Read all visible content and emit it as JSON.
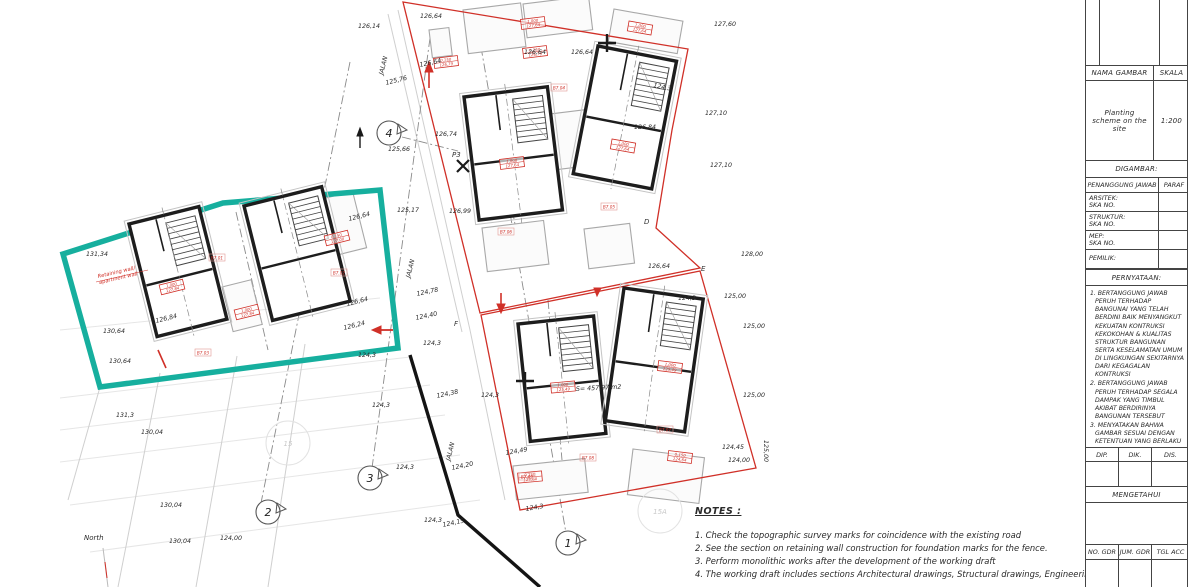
{
  "colors": {
    "teal": "#16af9e",
    "red": "#d03028",
    "wall": "#1d1d1d"
  },
  "title_block": {
    "nama_gambar_label": "NAMA GAMBAR",
    "skala_label": "SKALA",
    "drawing_title": "Planting scheme on the site",
    "scale_value": "1:200",
    "digambar_label": "DIGAMBAR:",
    "penanggung_label": "PENANGGUNG JAWAB",
    "paraf_label": "PARAF",
    "party_rows": [
      {
        "label": "ARSITEK:",
        "sub": "SKA NO."
      },
      {
        "label": "STRUKTUR:",
        "sub": "SKA NO."
      },
      {
        "label": "MEP:",
        "sub": "SKA NO."
      },
      {
        "label": "PEMILIK:",
        "sub": ""
      }
    ],
    "pernyataan_label": "PERNYATAAN:",
    "statements": [
      "1. BERTANGGUNG JAWAB PERUH TERHADAP BANGUNAI YANG TELAH BERDINI BAIK MENYANGKUT KEKUATAN KONTRUKSI KEKOKOHAN & KUALITAS STRUKTUR BANGUNAN SERTA KESELAMATAN UMUM DI LINGKUNGAN SEKITARNYA DARI KEGAGALAN KONTRUKSI",
      "2. BERTANGGUNG JAWAB PERUH TERHADAP SEGALA DAMPAK YANG TIMBUL AKIBAT BERDIRINYA BANGUNAN TERSEBUT",
      "3. MENYATAKAN BAHWA GAMBAR SESUAI DENGAN KETENTUAN YANG BERLAKU"
    ],
    "sign_columns": [
      "DIP.",
      "DIK.",
      "DIS."
    ],
    "mengetahui_label": "MENGETAHUI",
    "footer_columns": [
      "NO. GDR",
      "JUM. GDR",
      "TGL ACC"
    ]
  },
  "notes": {
    "heading": "NOTES :",
    "items": [
      "1. Check the topographic survey marks for coincidence with the existing road",
      "2. See the section on retaining wall construction for foundation marks for the fence.",
      "3. Perform monolithic works after the development of the working draft",
      "4. The working draft includes sections Architectural drawings, Structural drawings, Engineering."
    ]
  },
  "plan": {
    "north_label": "North",
    "retaining_note": [
      "Retaining wall/",
      "apartment wall"
    ],
    "labels": [
      {
        "t": "126,14",
        "x": 358,
        "y": 28
      },
      {
        "t": "126,64",
        "x": 420,
        "y": 18
      },
      {
        "t": "126,64",
        "x": 524,
        "y": 54
      },
      {
        "t": "126,64",
        "x": 571,
        "y": 54
      },
      {
        "t": "126,64",
        "x": 420,
        "y": 67,
        "rot": -12
      },
      {
        "t": "127,60",
        "x": 714,
        "y": 26
      },
      {
        "t": "127,10",
        "x": 705,
        "y": 115
      },
      {
        "t": "127,10",
        "x": 710,
        "y": 167
      },
      {
        "t": "128,00",
        "x": 741,
        "y": 256
      },
      {
        "t": "126,64",
        "x": 648,
        "y": 268
      },
      {
        "t": "125,00",
        "x": 724,
        "y": 298
      },
      {
        "t": "124,3",
        "x": 678,
        "y": 300
      },
      {
        "t": "126,84",
        "x": 634,
        "y": 129
      },
      {
        "t": "126,74",
        "x": 435,
        "y": 136
      },
      {
        "t": "125,76",
        "x": 386,
        "y": 85,
        "rot": -14
      },
      {
        "t": "125,66",
        "x": 388,
        "y": 151
      },
      {
        "t": "125,17",
        "x": 397,
        "y": 212
      },
      {
        "t": "126,99",
        "x": 449,
        "y": 213
      },
      {
        "t": "131,34",
        "x": 86,
        "y": 256
      },
      {
        "t": "126,84",
        "x": 156,
        "y": 323,
        "rot": -14
      },
      {
        "t": "130,64",
        "x": 103,
        "y": 333
      },
      {
        "t": "130,64",
        "x": 109,
        "y": 363
      },
      {
        "t": "126,64",
        "x": 349,
        "y": 221,
        "rot": -14
      },
      {
        "t": "126,64",
        "x": 347,
        "y": 306,
        "rot": -14
      },
      {
        "t": "126,24",
        "x": 344,
        "y": 330,
        "rot": -14
      },
      {
        "t": "124,3",
        "x": 358,
        "y": 357
      },
      {
        "t": "124,78",
        "x": 417,
        "y": 296,
        "rot": -12
      },
      {
        "t": "124,40",
        "x": 416,
        "y": 320,
        "rot": -12
      },
      {
        "t": "124,3",
        "x": 423,
        "y": 345
      },
      {
        "t": "124,38",
        "x": 437,
        "y": 398,
        "rot": -12
      },
      {
        "t": "124,20",
        "x": 452,
        "y": 470,
        "rot": -12
      },
      {
        "t": "124,3",
        "x": 396,
        "y": 469
      },
      {
        "t": "124,3",
        "x": 424,
        "y": 522
      },
      {
        "t": "124,15",
        "x": 443,
        "y": 527,
        "rot": -12
      },
      {
        "t": "124,3",
        "x": 481,
        "y": 397
      },
      {
        "t": "125,00",
        "x": 743,
        "y": 328
      },
      {
        "t": "125,00",
        "x": 743,
        "y": 397
      },
      {
        "t": "124,49",
        "x": 506,
        "y": 455,
        "rot": -10
      },
      {
        "t": "124,45",
        "x": 722,
        "y": 449
      },
      {
        "t": "124,00",
        "x": 728,
        "y": 462
      },
      {
        "t": "125,00",
        "x": 764,
        "y": 440,
        "rot": 90
      },
      {
        "t": "124,3",
        "x": 526,
        "y": 511,
        "rot": -10
      },
      {
        "t": "124,00",
        "x": 220,
        "y": 540
      },
      {
        "t": "131,3",
        "x": 116,
        "y": 417
      },
      {
        "t": "130,04",
        "x": 141,
        "y": 434
      },
      {
        "t": "130,04",
        "x": 160,
        "y": 507
      },
      {
        "t": "130,04",
        "x": 169,
        "y": 543
      },
      {
        "t": "124,3",
        "x": 372,
        "y": 407
      },
      {
        "t": "124,3",
        "x": 653,
        "y": 87,
        "rot": 12
      },
      {
        "t": "S= 457,97 m2",
        "x": 576,
        "y": 391,
        "rot": -3
      },
      {
        "t": "JALAN",
        "x": 383,
        "y": 75,
        "rot": -76
      },
      {
        "t": "JALAN",
        "x": 410,
        "y": 278,
        "rot": -76
      },
      {
        "t": "JALAN",
        "x": 450,
        "y": 461,
        "rot": -76
      }
    ],
    "grid_letters": [
      {
        "t": "D",
        "x": 644,
        "y": 224
      },
      {
        "t": "E",
        "x": 701,
        "y": 271
      },
      {
        "t": "F",
        "x": 454,
        "y": 326
      },
      {
        "t": "P3",
        "x": 452,
        "y": 157
      }
    ],
    "axis_bubbles": [
      {
        "n": "1",
        "x": 568,
        "y": 543
      },
      {
        "n": "2",
        "x": 268,
        "y": 512
      },
      {
        "n": "3",
        "x": 370,
        "y": 478
      },
      {
        "n": "4",
        "x": 389,
        "y": 133
      }
    ],
    "ref_circles": [
      {
        "n": "15",
        "x": 288,
        "y": 443
      },
      {
        "n": "15A",
        "x": 660,
        "y": 511
      }
    ],
    "level_boxes": [
      {
        "x": 533,
        "y": 23,
        "l1": "1,000",
        "l2": "127,64",
        "rot": -7
      },
      {
        "x": 640,
        "y": 28,
        "l1": "1,000",
        "l2": "127,64",
        "rot": 10
      },
      {
        "x": 535,
        "y": 52,
        "l1": "0,150",
        "l2": "126,79",
        "rot": -7
      },
      {
        "x": 446,
        "y": 62,
        "l1": "0,150",
        "l2": "126,79",
        "rot": -7
      },
      {
        "x": 623,
        "y": 146,
        "l1": "1,000",
        "l2": "127,64",
        "rot": 10
      },
      {
        "x": 512,
        "y": 163,
        "l1": "1,000",
        "l2": "127,64",
        "rot": -7
      },
      {
        "x": 172,
        "y": 287,
        "l1": "1,000",
        "l2": "127,84",
        "rot": -14
      },
      {
        "x": 247,
        "y": 312,
        "l1": "1,000",
        "l2": "127,84",
        "rot": -14
      },
      {
        "x": 337,
        "y": 238,
        "l1": "0,150",
        "l2": "127,00",
        "rot": -14
      },
      {
        "x": 563,
        "y": 387,
        "l1": "1,000",
        "l2": "125,49",
        "rot": -5
      },
      {
        "x": 670,
        "y": 367,
        "l1": "1,000",
        "l2": "125,49",
        "rot": 7
      },
      {
        "x": 680,
        "y": 457,
        "l1": "0,150",
        "l2": "124,64",
        "rot": 7
      },
      {
        "x": 530,
        "y": 477,
        "l1": "0,150",
        "l2": "124,64",
        "rot": -5
      }
    ],
    "red_tags": [
      {
        "t": "B7.01",
        "x": 217,
        "y": 258
      },
      {
        "t": "B7.02",
        "x": 339,
        "y": 273
      },
      {
        "t": "B7.03",
        "x": 203,
        "y": 353
      },
      {
        "t": "B7.04",
        "x": 559,
        "y": 88
      },
      {
        "t": "B7.05",
        "x": 609,
        "y": 207
      },
      {
        "t": "B7.06",
        "x": 506,
        "y": 232
      },
      {
        "t": "B7.07",
        "x": 665,
        "y": 430
      },
      {
        "t": "B7.08",
        "x": 588,
        "y": 458
      },
      {
        "t": "B7.09",
        "x": 527,
        "y": 477
      }
    ]
  }
}
